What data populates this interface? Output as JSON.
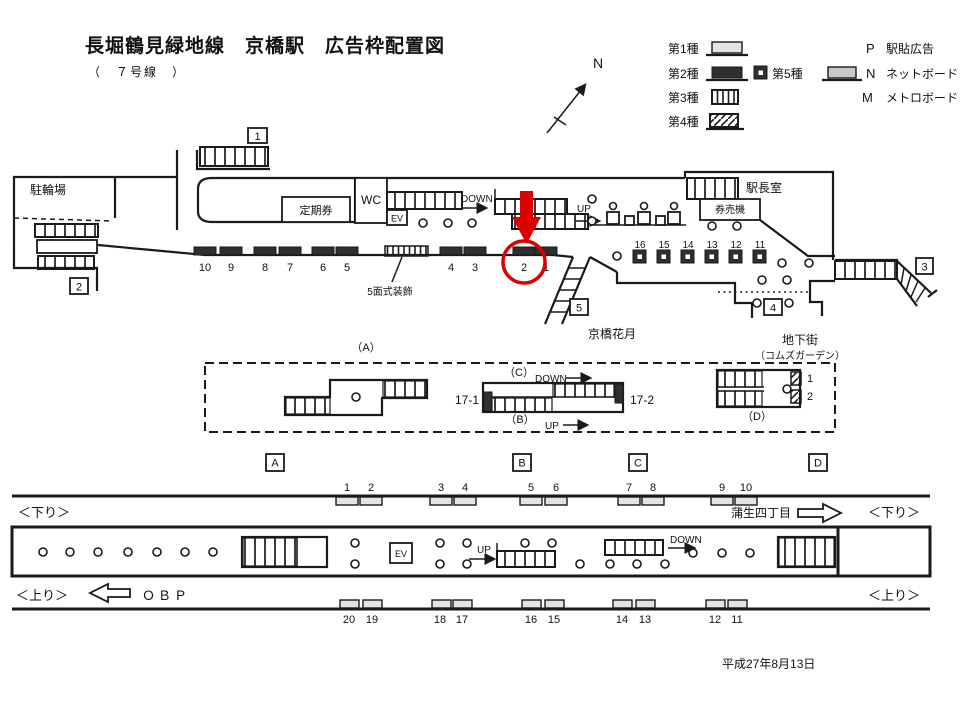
{
  "title": "長堀鶴見緑地線　京橋駅　広告枠配置図",
  "subtitle": "（　７号線　）",
  "date": "平成27年8月13日",
  "compass": {
    "north": "N"
  },
  "legend": {
    "type1": "第1種",
    "type2": "第2種",
    "type3": "第3種",
    "type4": "第4種",
    "type5": "第5種",
    "p_key": "P",
    "p_label": "駅貼広告",
    "n_key": "N",
    "n_label": "ネットボード",
    "m_key": "M",
    "m_label": "メトロボード"
  },
  "concourse": {
    "bicycle_parking": "駐輪場",
    "commuter_pass": "定期券",
    "wc": "WC",
    "ev": "EV",
    "down": "DOWN",
    "up": "UP",
    "station_master": "駅長室",
    "ticket_machines": "券売機",
    "five_panel": "5面式装飾",
    "kyobashi_kagetsu": "京橋花月",
    "underground_mall": "地下街",
    "coms_garden": "（コムズガーデン）",
    "exit1": "1",
    "exit2": "2",
    "exit3": "3",
    "exit4": "4",
    "exit5": "5",
    "type2_ads": [
      "10",
      "9",
      "8",
      "7",
      "6",
      "5",
      "4",
      "3",
      "2",
      "1"
    ],
    "type5_ads": [
      "16",
      "15",
      "14",
      "13",
      "12",
      "11"
    ],
    "highlighted_ad": "2"
  },
  "mezzanine": {
    "label_a": "（A）",
    "label_b": "（B）",
    "label_c": "（C）",
    "label_d": "（D）",
    "down": "DOWN",
    "up": "UP",
    "esc_left": "17-1",
    "esc_right": "17-2",
    "d_ad1": "1",
    "d_ad2": "2",
    "box_a": "A",
    "box_b": "B",
    "box_c": "C",
    "box_d": "D"
  },
  "platform": {
    "down_left": "＜下り＞",
    "down_right": "＜下り＞",
    "up_left": "＜上り＞",
    "up_right": "＜上り＞",
    "obp": "ＯＢＰ",
    "gamo": "蒲生四丁目",
    "ev": "EV",
    "up": "UP",
    "down": "DOWN",
    "top_ads": [
      "1",
      "2",
      "3",
      "4",
      "5",
      "6",
      "7",
      "8",
      "9",
      "10"
    ],
    "bottom_ads": [
      "20",
      "19",
      "18",
      "17",
      "16",
      "15",
      "14",
      "13",
      "12",
      "11"
    ]
  },
  "colors": {
    "line": "#1a1a1a",
    "dark_ad": "#2f2f2f",
    "light_ad": "#e3e3e3",
    "net_board": "#c9c9c9",
    "highlight": "#dd0000"
  }
}
